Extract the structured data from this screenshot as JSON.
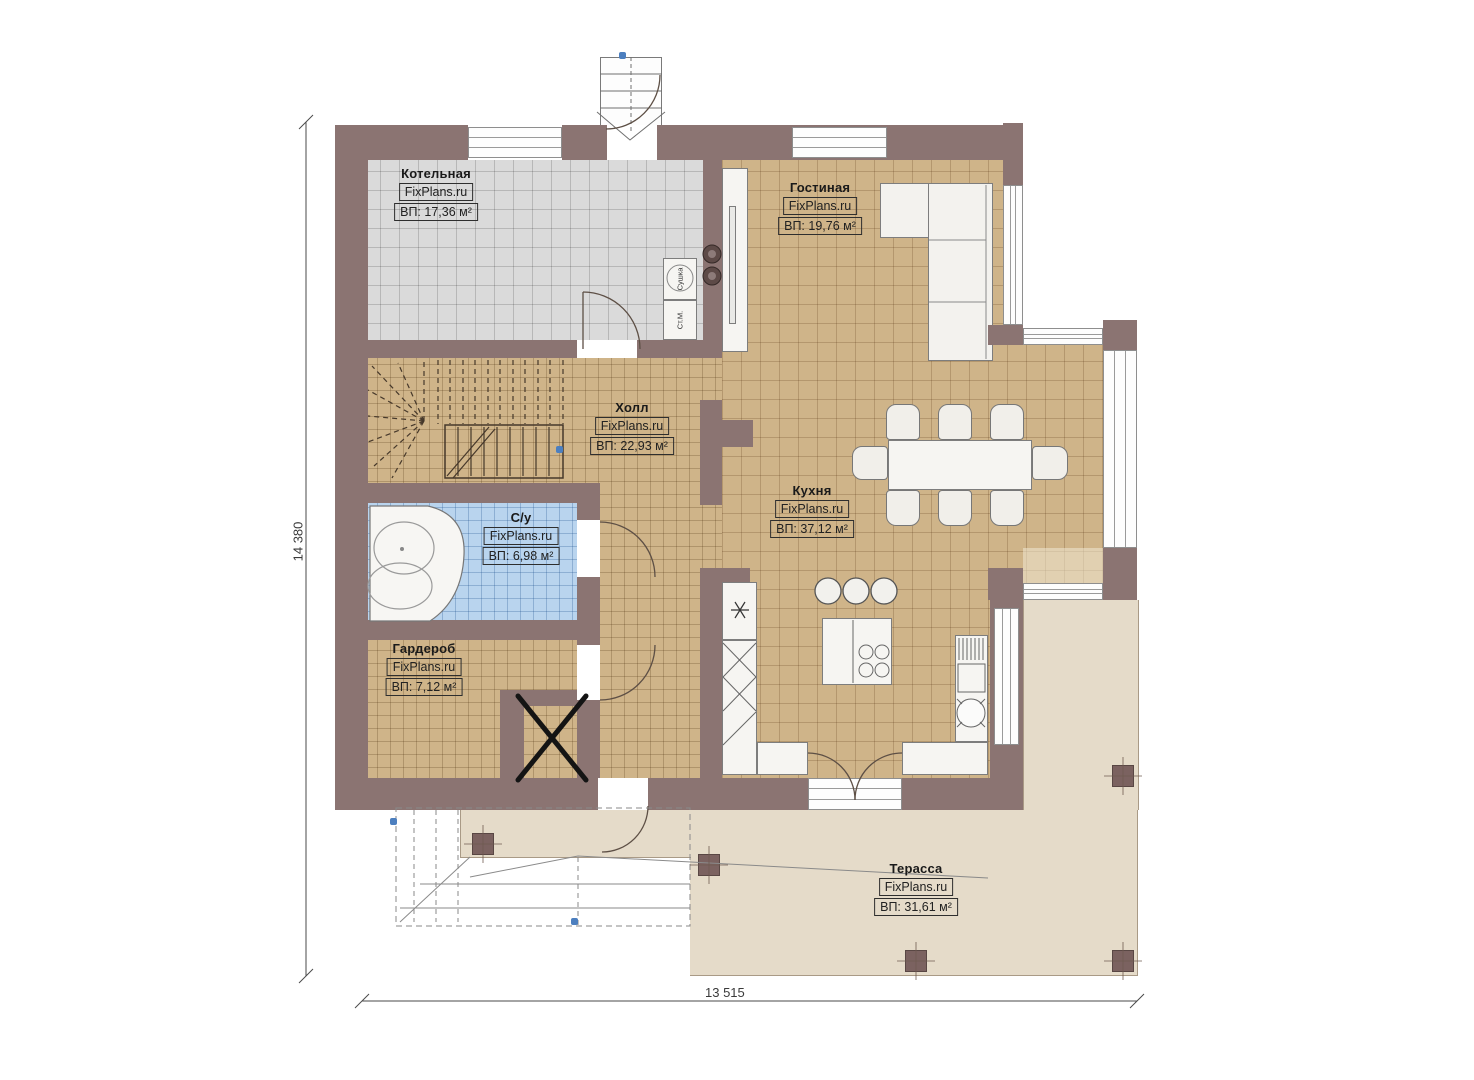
{
  "rooms": [
    {
      "name": "Котельная",
      "brand": "FixPlans.ru",
      "area": "ВП: 17,36 м²"
    },
    {
      "name": "Гостиная",
      "brand": "FixPlans.ru",
      "area": "ВП: 19,76 м²"
    },
    {
      "name": "Холл",
      "brand": "FixPlans.ru",
      "area": "ВП: 22,93 м²"
    },
    {
      "name": "Кухня",
      "brand": "FixPlans.ru",
      "area": "ВП: 37,12 м²"
    },
    {
      "name": "С/у",
      "brand": "FixPlans.ru",
      "area": "ВП: 6,98 м²"
    },
    {
      "name": "Гардероб",
      "brand": "FixPlans.ru",
      "area": "ВП: 7,12 м²"
    },
    {
      "name": "Терасса",
      "brand": "FixPlans.ru",
      "area": "ВП: 31,61 м²"
    }
  ],
  "dimensions": {
    "height_label": "14 380",
    "width_label": "13 515"
  },
  "appliances": {
    "washer_label": "Ст.М.",
    "dryer_label": "Сушка"
  },
  "colors": {
    "wall": "#8b7472",
    "floor_tan": "#cfb489",
    "floor_gray": "#dadada",
    "floor_bath": "#b9d4ee",
    "terrace": "#e5dbc9",
    "marker_blue": "#4c7fbf"
  }
}
